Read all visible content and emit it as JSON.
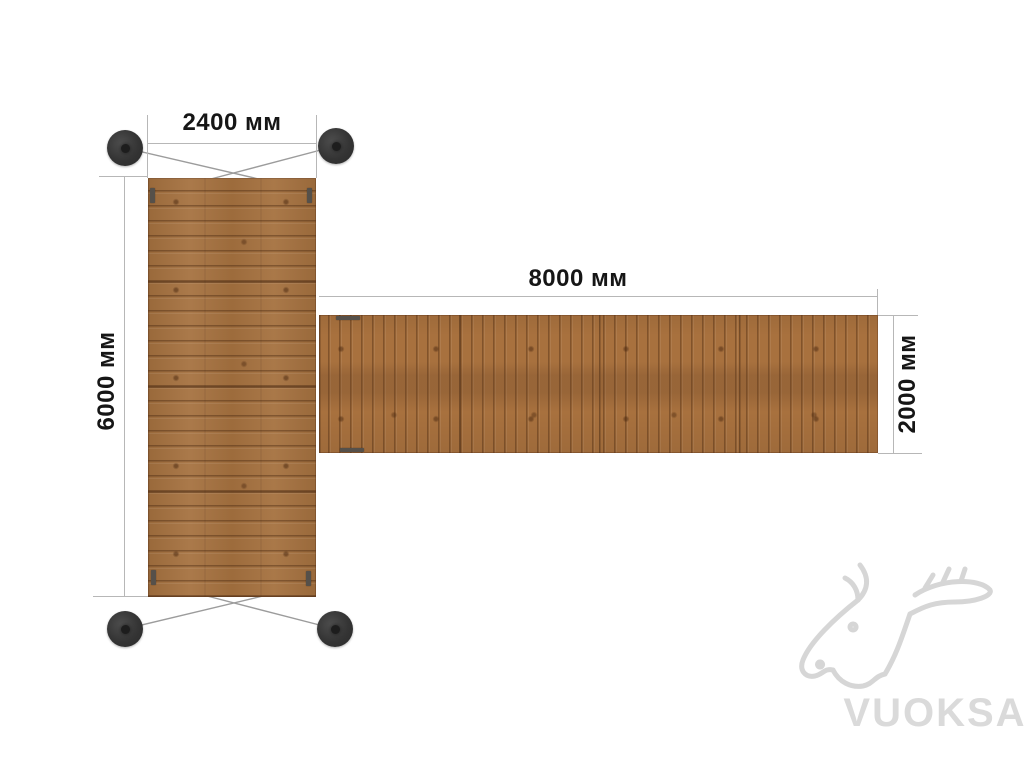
{
  "diagram": {
    "type": "pontoon-layout-top-view",
    "pontoon": {
      "width_label": "2400 мм",
      "length_label": "6000 мм"
    },
    "walkway": {
      "length_label": "8000 мм",
      "width_label": "2000 мм"
    },
    "anchors_count": 4
  },
  "watermark": {
    "brand": "VUOKSA"
  },
  "colors": {
    "background": "#ffffff",
    "wood": "#a8713e",
    "wood_seam": "#6d4426",
    "dimension_line": "#b7b7b7",
    "label_text": "#161616",
    "anchor": "#343434",
    "bracket": "#55504a",
    "watermark": "#d8d8d8"
  }
}
